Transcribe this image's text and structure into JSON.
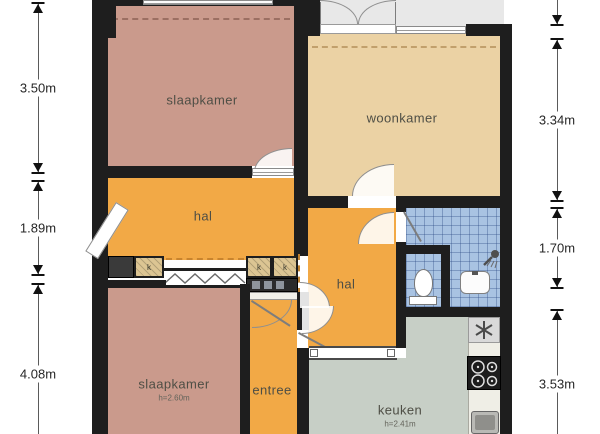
{
  "plan": {
    "dimensions": {
      "left": [
        {
          "label": "3.50m"
        },
        {
          "label": "1.89m"
        },
        {
          "label": "4.08m"
        }
      ],
      "right": [
        {
          "label": "3.34m"
        },
        {
          "label": "1.70m"
        },
        {
          "label": "3.53m"
        }
      ]
    },
    "rooms": {
      "slaapkamer_top": {
        "label": "slaapkamer"
      },
      "woonkamer": {
        "label": "woonkamer"
      },
      "hal_upper": {
        "label": "hal"
      },
      "hal_lower": {
        "label": "hal"
      },
      "slaapkamer_bottom": {
        "label": "slaapkamer",
        "ceiling": "h=2.60m"
      },
      "entree": {
        "label": "entree"
      },
      "keuken": {
        "label": "keuken",
        "ceiling": "h=2.41m"
      },
      "closet": {
        "label": "k"
      }
    },
    "fixtures": {
      "toilet": "toilet-icon",
      "washbasin": "washbasin-icon",
      "shower": "shower-icon",
      "stove": "stove-icon",
      "extractor": "extractor-fan-icon",
      "kitchen_sink": "kitchen-sink-icon"
    }
  },
  "colors": {
    "wall": "#1e1e1e",
    "bedroom": "#ca9a8c",
    "living": "#ebd2a4",
    "hall": "#f2a946",
    "kitchen": "#c7cfc6",
    "bath": "#a9c3e2",
    "balcony": "#e8e8e8",
    "closet": "#dcc593",
    "counter": "#efeee6",
    "dark_unit": "#3a3a3a"
  }
}
